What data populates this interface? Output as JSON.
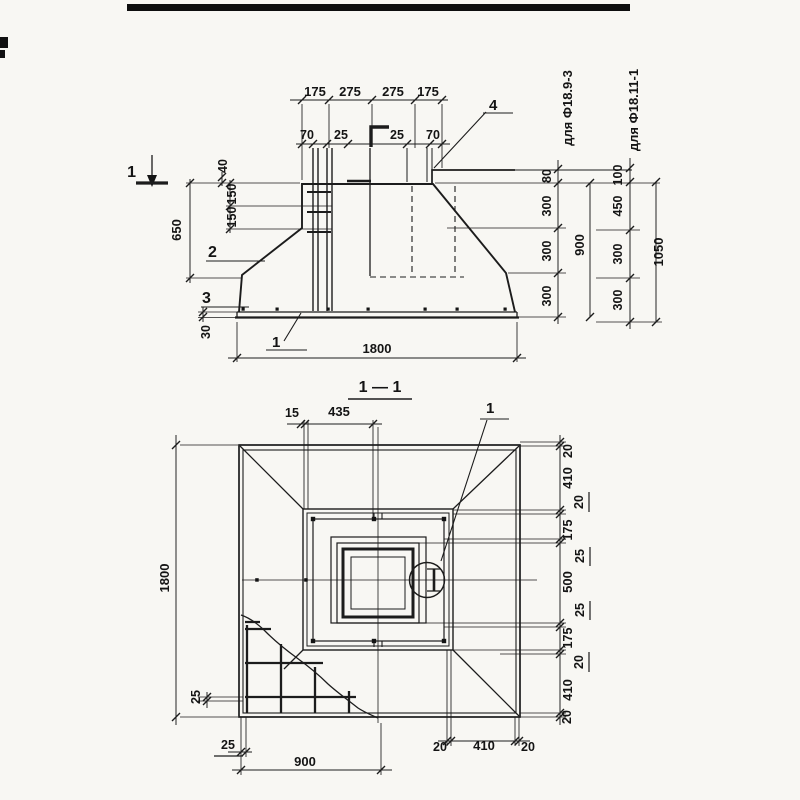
{
  "elev": {
    "top_dims": [
      "175",
      "275",
      "275",
      "175"
    ],
    "bolt_dims": [
      "70",
      "25",
      "25",
      "70"
    ],
    "left_dims": {
      "h650": "650",
      "h40": "40",
      "h150a": "150",
      "h150b": "150",
      "h30": "30"
    },
    "callouts": {
      "c1": "1",
      "c2": "2",
      "c3": "3",
      "c4": "4",
      "section_mark": "1"
    },
    "chain1": {
      "seg": [
        "80",
        "300",
        "300",
        "300"
      ],
      "total": "900",
      "label": "для Ф18.9-3"
    },
    "chain2": {
      "seg": [
        "100",
        "450",
        "300",
        "300"
      ],
      "total": "1050",
      "label": "для Ф18.11-1"
    },
    "width": "1800"
  },
  "plan": {
    "title": "1 — 1",
    "top_dims": {
      "d15": "15",
      "d435": "435"
    },
    "left_dims": {
      "h1800": "1800",
      "d25": "25"
    },
    "bottom_dims": {
      "d25": "25",
      "w900": "900",
      "chain": [
        "20",
        "410",
        "20"
      ]
    },
    "right_chain": [
      "20",
      "410",
      "20",
      "175",
      "25",
      "500",
      "25",
      "175",
      "20",
      "410",
      "20"
    ],
    "callout1": "1"
  }
}
